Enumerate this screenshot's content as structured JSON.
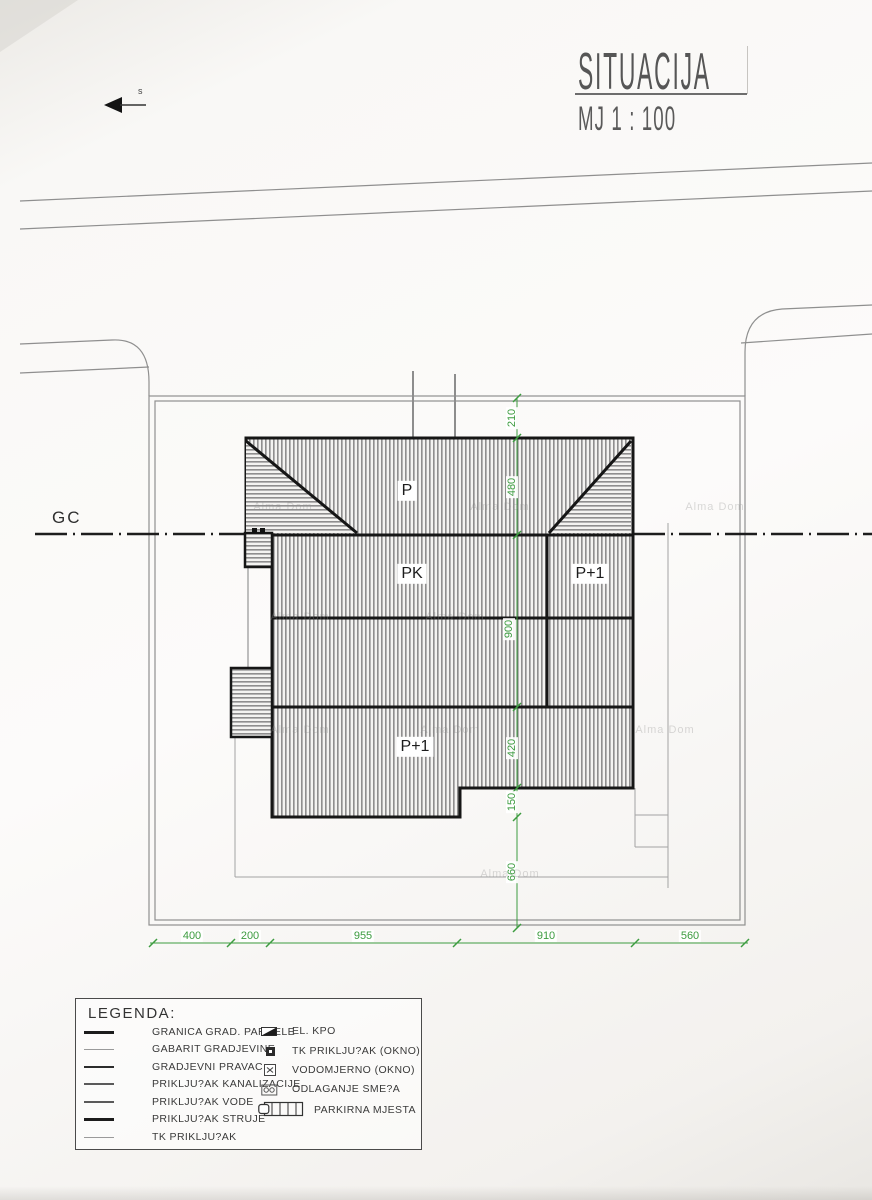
{
  "title": {
    "main": "SITUACIJA",
    "scale": "MJ 1 : 100"
  },
  "north_label": "s",
  "gc_label": "GC",
  "building_labels": {
    "roof": "P",
    "attic": "PK",
    "right_wing": "P+1",
    "bottom_wing": "P+1"
  },
  "dimensions": {
    "vertical": [
      {
        "value": "210"
      },
      {
        "value": "480"
      },
      {
        "value": "900"
      },
      {
        "value": "420"
      },
      {
        "value": "150"
      },
      {
        "value": "660"
      }
    ],
    "horizontal": [
      {
        "value": "400"
      },
      {
        "value": "200"
      },
      {
        "value": "955"
      },
      {
        "value": "910"
      },
      {
        "value": "560"
      }
    ]
  },
  "legend": {
    "heading": "LEGENDA:",
    "line_items": [
      {
        "label": "GRANICA GRAD. PARCELE",
        "style": "thick"
      },
      {
        "label": "GABARIT GRADJEVINE",
        "style": "thin-light"
      },
      {
        "label": "GRADJEVNI PRAVAC",
        "style": "medium"
      },
      {
        "label": "PRIKLJU?AK KANALIZACIJE",
        "style": "thin"
      },
      {
        "label": "PRIKLJU?AK VODE",
        "style": "thin"
      },
      {
        "label": "PRIKLJU?AK STRUJE",
        "style": "thick"
      },
      {
        "label": "TK PRIKLJU?AK",
        "style": "thin-light"
      }
    ],
    "symbol_items": [
      {
        "label": "EL. KPO",
        "icon": "el-kpo-icon"
      },
      {
        "label": "TK PRIKLJU?AK (OKNO)",
        "icon": "tk-window-icon"
      },
      {
        "label": "VODOMJERNO (OKNO)",
        "icon": "water-meter-icon"
      },
      {
        "label": "ODLAGANJE SME?A",
        "icon": "waste-disposal-icon"
      },
      {
        "label": "PARKIRNA MJESTA",
        "icon": "parking-spaces-icon"
      }
    ]
  },
  "watermark": "Alma Dom",
  "colors": {
    "dimension_green": "#3d9c40",
    "line_dark": "#1c1c1c",
    "line_light": "#999999"
  }
}
